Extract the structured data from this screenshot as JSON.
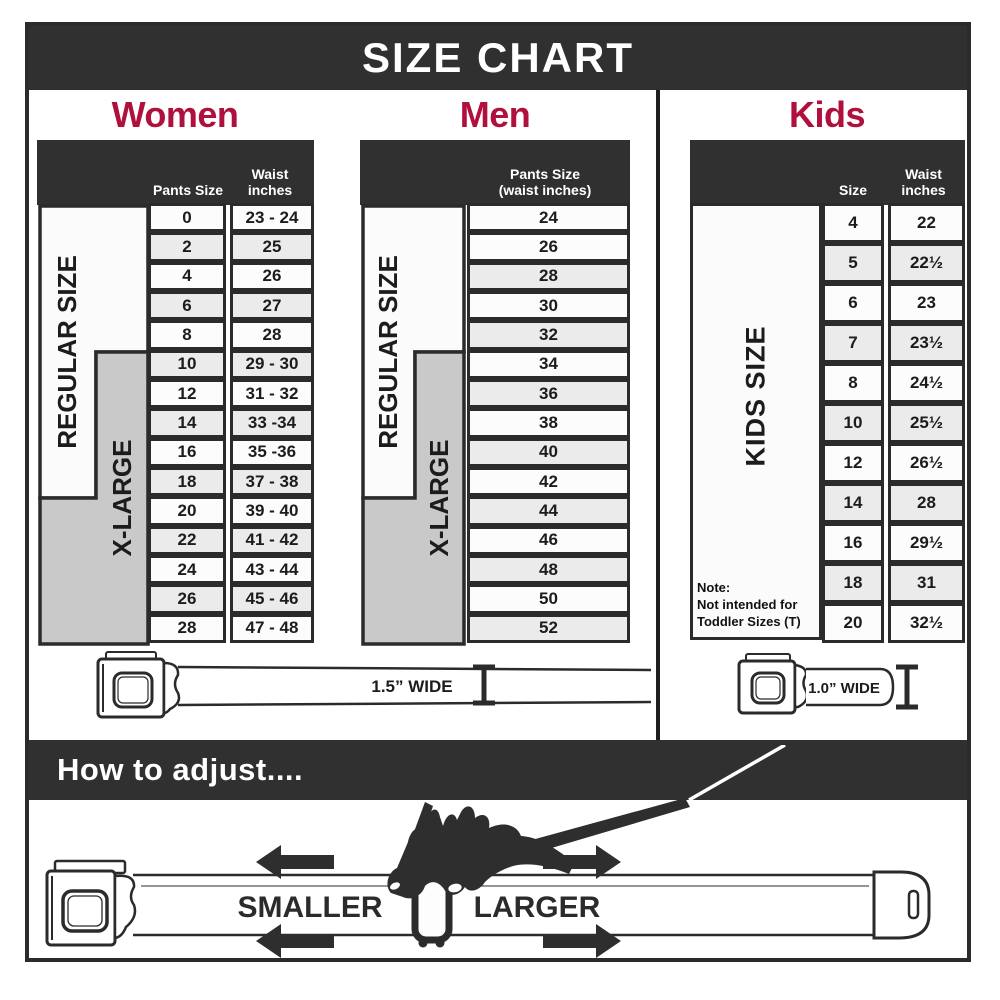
{
  "title": "SIZE CHART",
  "colors": {
    "accent": "#b0103c",
    "dark_bar": "#303030",
    "border": "#2b2b2b",
    "xlarge_fill": "#c9c9c9",
    "row_alt": "#ebebeb"
  },
  "labels": {
    "regular": "REGULAR SIZE",
    "xlarge": "X-LARGE",
    "kids_side": "KIDS SIZE"
  },
  "women": {
    "title": "Women",
    "col_pants": "Pants Size",
    "col_waist_1": "Waist",
    "col_waist_2": "inches",
    "rows": [
      {
        "size": "0",
        "waist": "23 - 24"
      },
      {
        "size": "2",
        "waist": "25"
      },
      {
        "size": "4",
        "waist": "26"
      },
      {
        "size": "6",
        "waist": "27"
      },
      {
        "size": "8",
        "waist": "28"
      },
      {
        "size": "10",
        "waist": "29 - 30"
      },
      {
        "size": "12",
        "waist": "31 - 32"
      },
      {
        "size": "14",
        "waist": "33 -34"
      },
      {
        "size": "16",
        "waist": "35 -36"
      },
      {
        "size": "18",
        "waist": "37 - 38"
      },
      {
        "size": "20",
        "waist": "39 - 40"
      },
      {
        "size": "22",
        "waist": "41 - 42"
      },
      {
        "size": "24",
        "waist": "43 - 44"
      },
      {
        "size": "26",
        "waist": "45 - 46"
      },
      {
        "size": "28",
        "waist": "47 - 48"
      }
    ]
  },
  "men": {
    "title": "Men",
    "col_line1": "Pants Size",
    "col_line2": "(waist inches)",
    "rows": [
      "24",
      "26",
      "28",
      "30",
      "32",
      "34",
      "36",
      "38",
      "40",
      "42",
      "44",
      "46",
      "48",
      "50",
      "52"
    ]
  },
  "kids": {
    "title": "Kids",
    "col_size": "Size",
    "col_waist_1": "Waist",
    "col_waist_2": "inches",
    "note_1": "Note:",
    "note_2": "Not intended for",
    "note_3": "Toddler Sizes (T)",
    "rows": [
      {
        "size": "4",
        "waist": "22"
      },
      {
        "size": "5",
        "waist": "22½"
      },
      {
        "size": "6",
        "waist": "23"
      },
      {
        "size": "7",
        "waist": "23½"
      },
      {
        "size": "8",
        "waist": "24½"
      },
      {
        "size": "10",
        "waist": "25½"
      },
      {
        "size": "12",
        "waist": "26½"
      },
      {
        "size": "14",
        "waist": "28"
      },
      {
        "size": "16",
        "waist": "29½"
      },
      {
        "size": "18",
        "waist": "31"
      },
      {
        "size": "20",
        "waist": "32½"
      }
    ]
  },
  "belts": {
    "adult": "1.5” WIDE",
    "kids": "1.0” WIDE"
  },
  "adjust": {
    "heading": "How to adjust....",
    "smaller": "SMALLER",
    "larger": "LARGER"
  }
}
